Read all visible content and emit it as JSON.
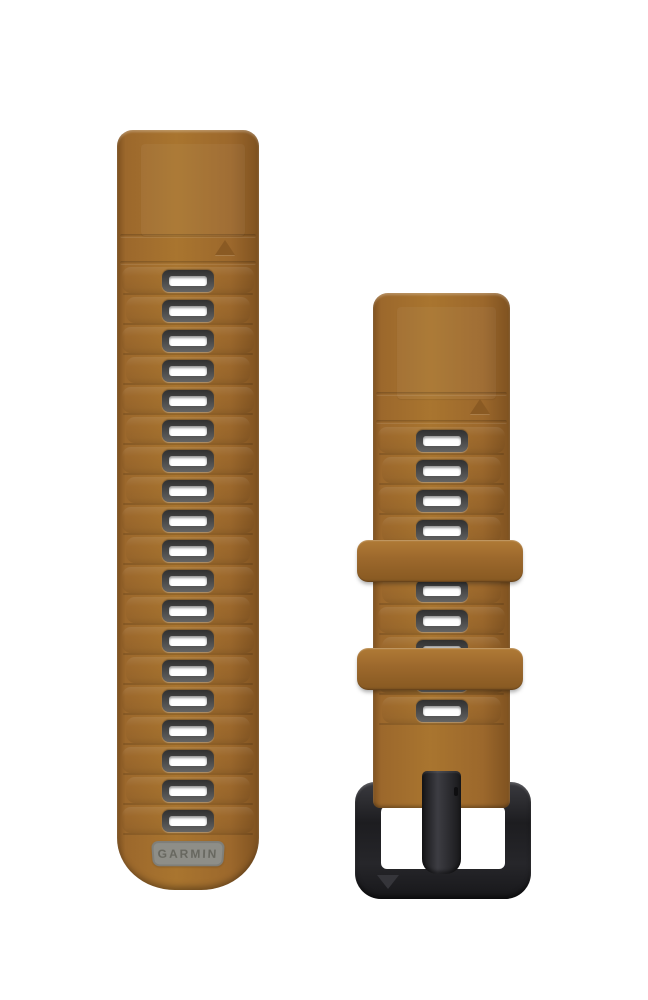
{
  "meta": {
    "description": "Product photo of a two-piece silicone watch strap in caramel tan on a white background",
    "background": "#ffffff"
  },
  "logo": {
    "text": "GARMIN"
  },
  "left_band": {
    "slot_count": 19,
    "marker": "triangle-up"
  },
  "right_band": {
    "slot_count": 10,
    "keeper_count": 2,
    "marker": "triangle-up",
    "buckle_marker": "triangle-down"
  },
  "colors": {
    "band_base": "#9c682c",
    "band_highlight": "#a9752f",
    "band_shadow": "#7f5220",
    "marker_triangle": "#8a5a23",
    "slot_frame_dark": "#303030",
    "slot_frame_light": "#646464",
    "slot_hole": "#ffffff",
    "logo_patch": "#8e8e88",
    "logo_text": "#67675f",
    "buckle_dark": "#1d1d20",
    "buckle_mid": "#26262a"
  }
}
